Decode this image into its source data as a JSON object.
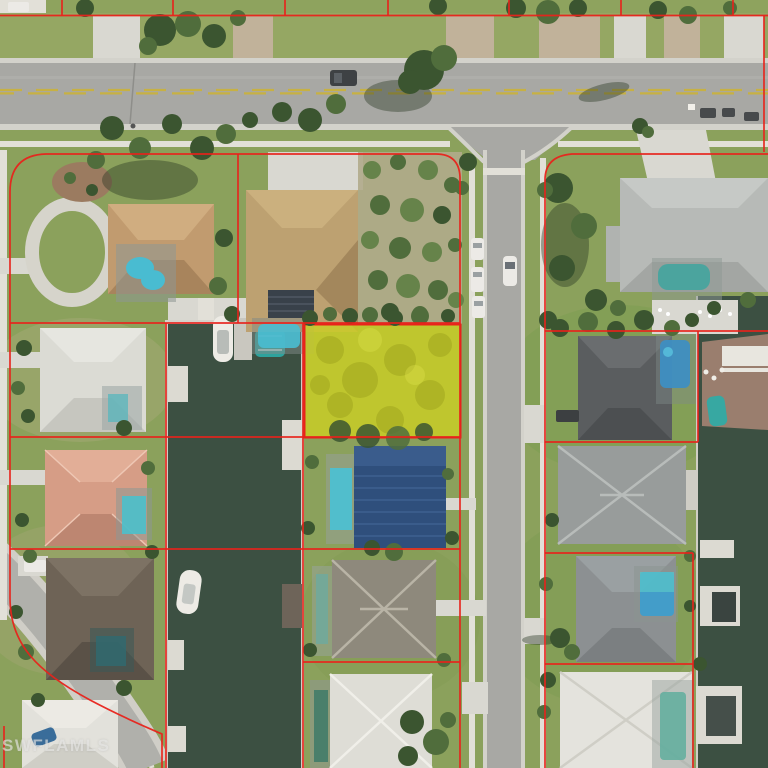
{
  "watermark": {
    "text": "SWFLAMLS"
  },
  "map": {
    "type": "aerial-parcel-map",
    "description": "Aerial MLS photo of a waterfront residential block with red parcel boundary overlay and a yellow-highlighted vacant lot",
    "colors": {
      "parcel_line": "#e8231b",
      "subject_highlight": "#ccd023",
      "water": "#3c5042",
      "road_asphalt": "#a8a8a4",
      "concrete": "#d9d8d1",
      "grass": "#8ba15c",
      "watermark_color": "rgba(236,236,234,0.62)"
    },
    "features": {
      "subject_parcel": "highlighted vacant lot, west side of street, canal frontage",
      "overlay": "red parcel boundary lines",
      "roads": [
        "main road (horizontal, top)",
        "residential street (vertical, center)",
        "curved street (bottom-left)"
      ],
      "canals": [
        "west canal with docked boats",
        "east canal with docks"
      ],
      "houses_visible": 13,
      "boats_visible": 5
    }
  }
}
